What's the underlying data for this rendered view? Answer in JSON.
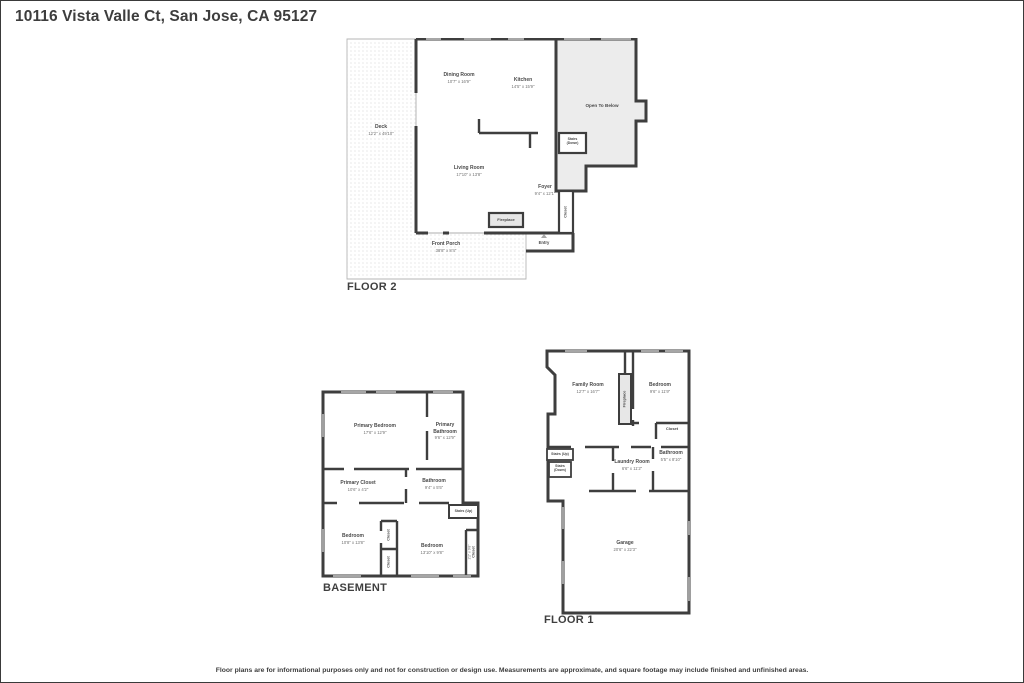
{
  "page": {
    "title": "10116 Vista Valle Ct, San Jose, CA 95127",
    "disclaimer": "Floor plans are for informational purposes only and not for construction or design use. Measurements are approximate, and square footage may include finished and unfinished areas."
  },
  "floor2": {
    "caption": "FLOOR 2",
    "deck": {
      "name": "Deck",
      "dims": "12'2\" x 49'10\""
    },
    "dining_room": {
      "name": "Dining Room",
      "dims": "10'7\" x 16'9\""
    },
    "kitchen": {
      "name": "Kitchen",
      "dims": "14'5\" x 15'9\""
    },
    "open_to_below": {
      "name": "Open To Below"
    },
    "stairs_down": {
      "line1": "Stairs",
      "line2": "(Down)"
    },
    "living_room": {
      "name": "Living Room",
      "dims": "17'10\" x 13'8\""
    },
    "foyer": {
      "name": "Foyer",
      "dims": "9'4\" x 12'1\""
    },
    "closet": {
      "name": "Closet"
    },
    "fireplace": {
      "name": "Fireplace"
    },
    "entry": {
      "name": "Entry"
    },
    "front_porch": {
      "name": "Front Porch",
      "dims": "38'8\" x 8'4\""
    }
  },
  "basement": {
    "caption": "BASEMENT",
    "primary_bedroom": {
      "name": "Primary Bedroom",
      "dims": "17'6\" x 12'9\""
    },
    "primary_bathroom": {
      "name": "Primary Bathroom",
      "dims": "9'6\" x 12'9\""
    },
    "primary_closet": {
      "name": "Primary Closet",
      "dims": "10'6\" x 4'2\""
    },
    "bathroom": {
      "name": "Bathroom",
      "dims": "9'4\" x 5'5\""
    },
    "stairs_up": {
      "name": "Stairs (Up)"
    },
    "bedroom_left": {
      "name": "Bedroom",
      "dims": "10'8\" x 13'8\""
    },
    "bedroom_right": {
      "name": "Bedroom",
      "dims": "13'10\" x 9'8\""
    },
    "closet_a": {
      "name": "Closet"
    },
    "closet_b": {
      "name": "Closet"
    },
    "closet_right": {
      "name": "Closet",
      "dims": "2'2\" x 9'8\""
    }
  },
  "floor1": {
    "caption": "FLOOR 1",
    "family_room": {
      "name": "Family Room",
      "dims": "12'7\" x 16'7\""
    },
    "fireplace": {
      "name": "Fireplace"
    },
    "bedroom": {
      "name": "Bedroom",
      "dims": "9'6\" x 11'9\""
    },
    "closet": {
      "name": "Closet"
    },
    "stairs_up": {
      "name": "Stairs (Up)"
    },
    "stairs_down": {
      "line1": "Stairs",
      "line2": "(Down)"
    },
    "laundry_room": {
      "name": "Laundry Room",
      "dims": "6'6\" x 11'2\""
    },
    "bathroom": {
      "name": "Bathroom",
      "dims": "5'5\" x 8'10\""
    },
    "garage": {
      "name": "Garage",
      "dims": "20'6\" x 22'3\""
    }
  }
}
